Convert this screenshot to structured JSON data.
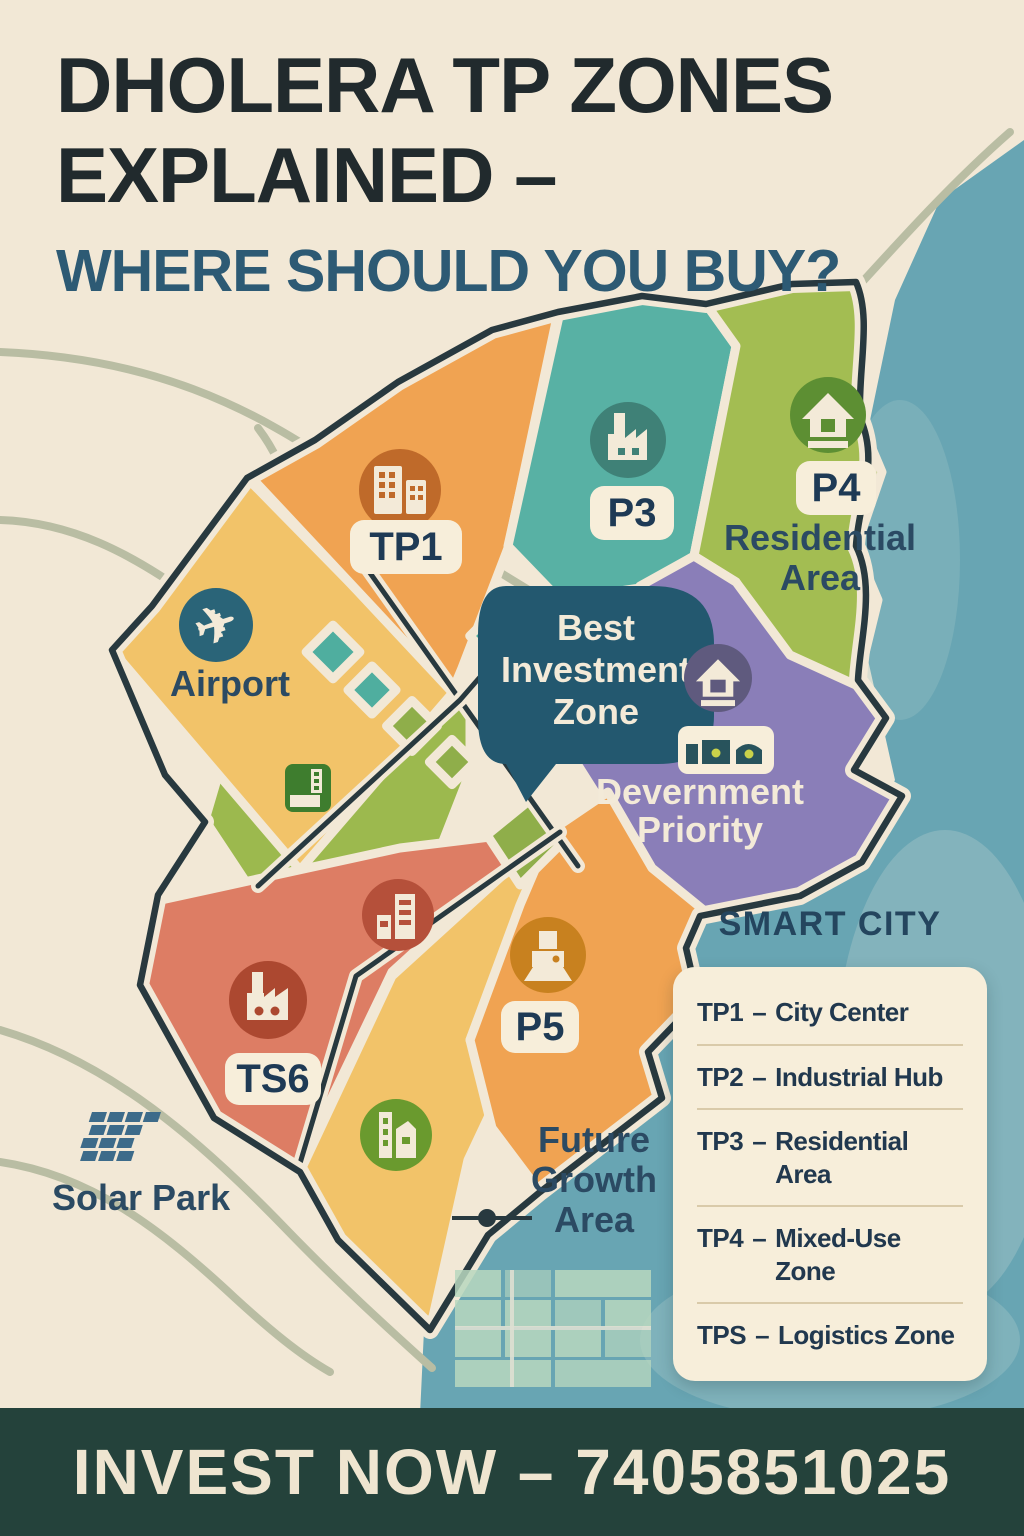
{
  "colors": {
    "bg": "#f2e8d6",
    "title_text": "#212a2d",
    "subtitle_text": "#2d5a74",
    "water": "#68a5b3",
    "water_wash": "#a3c6c8",
    "road_sage": "#b9bda3",
    "road_dark": "#28393f",
    "road_cream": "#f2e8d6",
    "zone_orange": "#f0a352",
    "zone_yellow": "#f2c369",
    "zone_teal": "#58b1a4",
    "zone_green": "#a3bd52",
    "zone_green_mid": "#9cb94e",
    "zone_purple": "#8a7eb8",
    "zone_salmon": "#dd7d64",
    "parcel_teal": "#4fae9f",
    "parcel_green": "#8fae4a",
    "parcel_purple": "#9187bd",
    "bubble_bg": "#23586f",
    "chip_bg": "#f7eeda",
    "chip_text": "#1e3a55",
    "map_label": "#2b4a63",
    "cream_text": "#f3ead8",
    "ic_tp1": "#bf6a2a",
    "ic_p3": "#3f8177",
    "ic_p4": "#5d8f33",
    "ic_airport": "#2a6478",
    "ic_purple": "#5f5a7e",
    "ic_ts6": "#ac4830",
    "ic_salmon": "#b5503a",
    "ic_p5": "#c8811f",
    "ic_green": "#6a9a2e",
    "ic_chip_green": "#3e7d2e",
    "ic_shed_dark": "#28535c",
    "ic_shed_dot": "#c9d24a",
    "solar_icon": "#3d6b8a",
    "grid_green": "#b9d8bf",
    "legend_bg": "#f7eeda",
    "legend_text": "#21384e",
    "legend_divider": "#d9caa9",
    "legend_title": "#24455e",
    "banner_bg": "#24423b",
    "banner_text": "#efe5d0"
  },
  "header": {
    "title_line1": "DHOLERA TP ZONES",
    "title_line2": "EXPLAINED –",
    "subtitle": "WHERE SHOULD YOU BUY?"
  },
  "map": {
    "zones": {
      "tp1": {
        "label": "TP1"
      },
      "p3": {
        "label": "P3"
      },
      "p4": {
        "label": "P4",
        "caption_line1": "Residential",
        "caption_line2": "Area"
      },
      "airport": {
        "label": "Airport"
      },
      "best_investment": {
        "line1": "Best",
        "line2": "Investment",
        "line3": "Zone"
      },
      "development_priority": {
        "line1": "Devernment",
        "line2": "Priority"
      },
      "ts6": {
        "label": "TS6"
      },
      "p5": {
        "label": "P5"
      },
      "future_growth": {
        "line1": "Future",
        "line2": "Growth",
        "line3": "Area"
      },
      "solar_park": {
        "label": "Solar Park"
      }
    }
  },
  "icons": {
    "plane": "✈"
  },
  "legend": {
    "title": "SMART CITY",
    "separator": "–",
    "items": [
      {
        "code": "TP1",
        "name": "City Center"
      },
      {
        "code": "TP2",
        "name": "Industrial Hub"
      },
      {
        "code": "TP3",
        "name": "Residential Area"
      },
      {
        "code": "TP4",
        "name": "Mixed-Use Zone"
      },
      {
        "code": "TPS",
        "name": "Logistics Zone"
      }
    ]
  },
  "footer": {
    "cta": "INVEST NOW – 7405851025"
  }
}
